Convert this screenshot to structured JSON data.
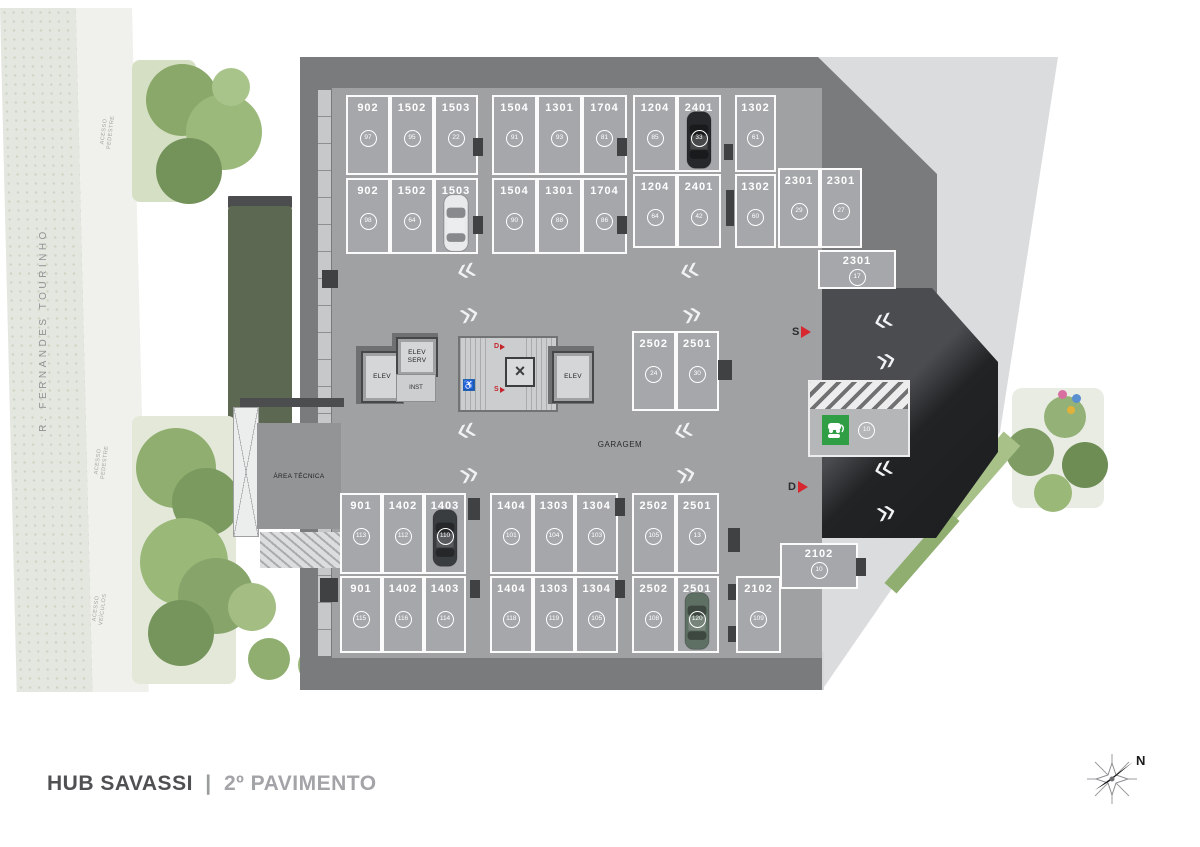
{
  "title": {
    "project": "HUB SAVASSI",
    "separator": "|",
    "floor": "2º PAVIMENTO"
  },
  "street": {
    "name": "R. FERNANDES TOURINHO"
  },
  "access": {
    "pedestre_top": "ACESSO\nPEDESTRE",
    "pedestre_mid": "ACESSO\nPEDESTRE",
    "veiculos": "ACESSO\nVEÍCULOS"
  },
  "labels": {
    "garagem": "GARAGEM",
    "area_tecnica": "ÁREA TÉCNICA",
    "elev_left": "ELEV",
    "elev_right": "ELEV",
    "elev_serv": "ELEV\nSERV",
    "inst": "INST",
    "ramp_up": "S",
    "ramp_down": "D",
    "stair_down": "D",
    "stair_up": "S"
  },
  "glyphs": {
    "chevron_left": "«",
    "chevron_right": "»",
    "elevator_x": "×",
    "accessibility": "♿"
  },
  "colors": {
    "accent_red": "#d7282f",
    "ev_green": "#2f9e44",
    "floor_gray": "#9fa1a3",
    "wall_gray": "#797b7d",
    "ramp_dark": "#232527",
    "plaza_gray": "#dbdcde"
  },
  "compass": {
    "north": "N"
  },
  "parking": {
    "ev_tag": "10",
    "groups": [
      {
        "key": "t1a",
        "spots": [
          {
            "num": "902",
            "tag": "97"
          },
          {
            "num": "1502",
            "tag": "95"
          },
          {
            "num": "1503",
            "tag": "22"
          }
        ]
      },
      {
        "key": "t1b",
        "spots": [
          {
            "num": "1504",
            "tag": "91"
          },
          {
            "num": "1301",
            "tag": "93"
          },
          {
            "num": "1704",
            "tag": "81"
          }
        ]
      },
      {
        "key": "t1c",
        "spots": [
          {
            "num": "1204",
            "tag": "85"
          },
          {
            "num": "2401",
            "tag": "33",
            "car": "black"
          }
        ]
      },
      {
        "key": "t1d",
        "spots": [
          {
            "num": "1302",
            "tag": "61"
          }
        ]
      },
      {
        "key": "t2a",
        "spots": [
          {
            "num": "902",
            "tag": "98"
          },
          {
            "num": "1502",
            "tag": "64"
          },
          {
            "num": "1503",
            "tag": null,
            "car": "silver"
          }
        ]
      },
      {
        "key": "t2b",
        "spots": [
          {
            "num": "1504",
            "tag": "90"
          },
          {
            "num": "1301",
            "tag": "88"
          },
          {
            "num": "1704",
            "tag": "86"
          }
        ]
      },
      {
        "key": "t2c",
        "spots": [
          {
            "num": "1204",
            "tag": "64"
          },
          {
            "num": "2401",
            "tag": "42"
          }
        ]
      },
      {
        "key": "t2d",
        "spots": [
          {
            "num": "1302",
            "tag": "60"
          }
        ]
      },
      {
        "key": "t2e",
        "spots": [
          {
            "num": "2301",
            "tag": "29"
          },
          {
            "num": "2301",
            "tag": "27"
          }
        ]
      },
      {
        "key": "h2301",
        "spots": [
          {
            "num": "2301",
            "tag": "17"
          }
        ]
      },
      {
        "key": "mid",
        "spots": [
          {
            "num": "2502",
            "tag": "24"
          },
          {
            "num": "2501",
            "tag": "30"
          }
        ]
      },
      {
        "key": "b1a",
        "spots": [
          {
            "num": "901",
            "tag": "113"
          },
          {
            "num": "1402",
            "tag": "112"
          },
          {
            "num": "1403",
            "tag": "110",
            "car": "charcoal"
          }
        ]
      },
      {
        "key": "b1b",
        "spots": [
          {
            "num": "1404",
            "tag": "101"
          },
          {
            "num": "1303",
            "tag": "104"
          },
          {
            "num": "1304",
            "tag": "103"
          }
        ]
      },
      {
        "key": "b1c",
        "spots": [
          {
            "num": "2502",
            "tag": "105"
          },
          {
            "num": "2501",
            "tag": "13"
          }
        ]
      },
      {
        "key": "b2a",
        "spots": [
          {
            "num": "901",
            "tag": "115"
          },
          {
            "num": "1402",
            "tag": "116"
          },
          {
            "num": "1403",
            "tag": "114"
          }
        ]
      },
      {
        "key": "b2b",
        "spots": [
          {
            "num": "1404",
            "tag": "118"
          },
          {
            "num": "1303",
            "tag": "119"
          },
          {
            "num": "1304",
            "tag": "105"
          }
        ]
      },
      {
        "key": "b2c",
        "spots": [
          {
            "num": "2502",
            "tag": "108"
          },
          {
            "num": "2501",
            "tag": "120",
            "car": "green"
          }
        ]
      },
      {
        "key": "b2d",
        "spots": [
          {
            "num": "2102",
            "tag": "109"
          }
        ]
      },
      {
        "key": "h2102",
        "spots": [
          {
            "num": "2102",
            "tag": "10"
          }
        ]
      }
    ]
  }
}
